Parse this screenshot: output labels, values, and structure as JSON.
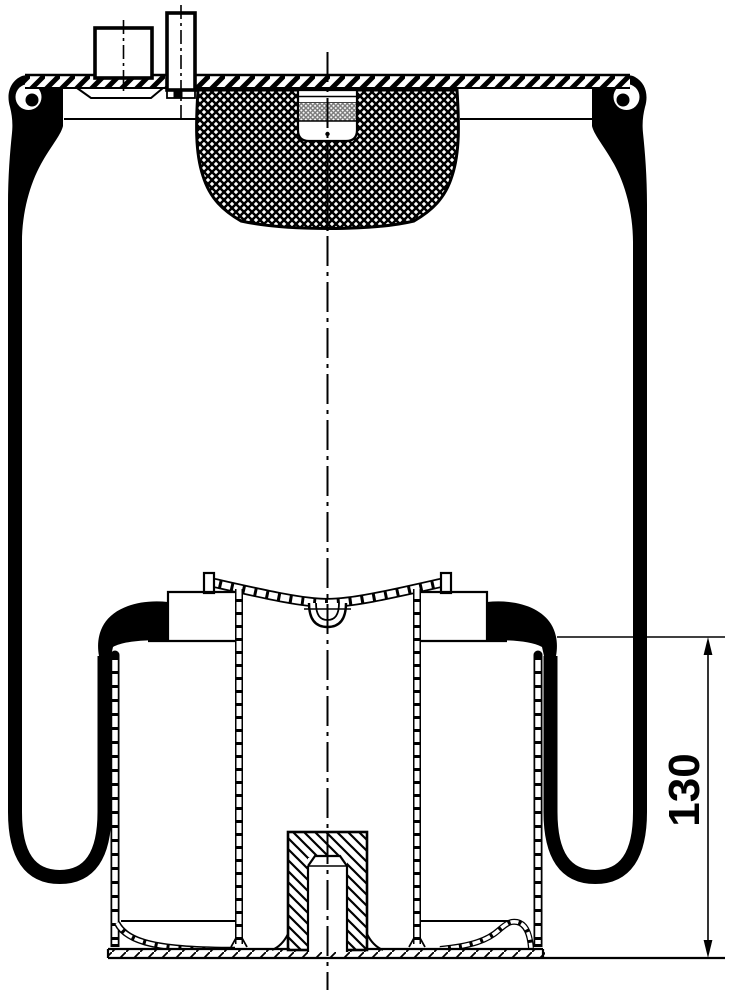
{
  "page": {
    "background": "#ffffff",
    "line_color": "#000000",
    "drawing_kind": "air-spring-cross-section"
  },
  "dimensions": {
    "height_label": "130"
  }
}
